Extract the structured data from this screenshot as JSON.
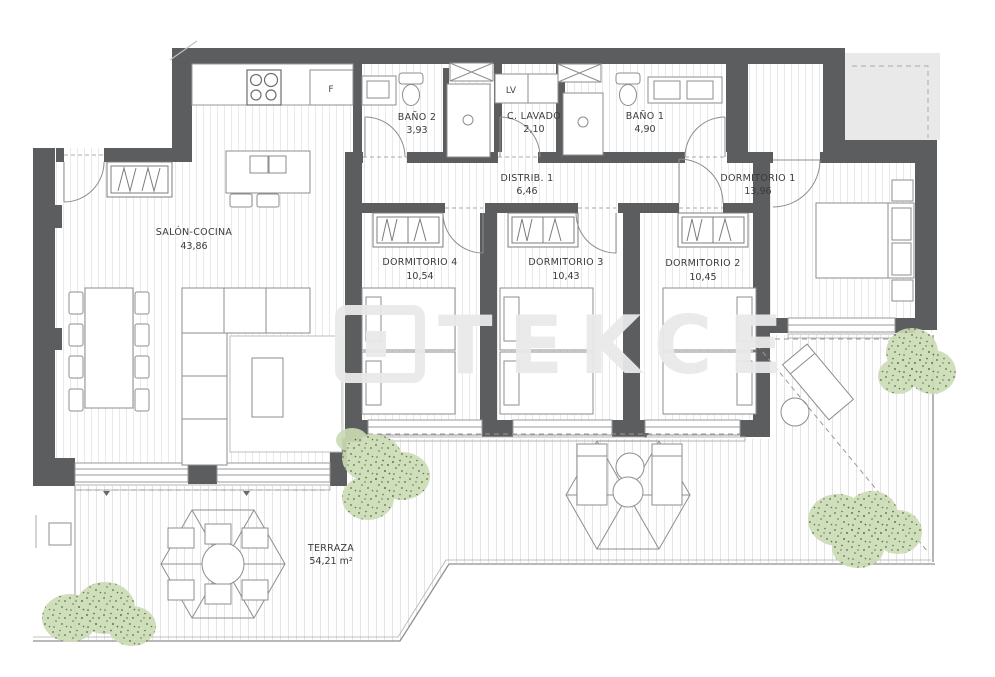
{
  "plan": {
    "watermark": "TEKCE",
    "rooms": [
      {
        "id": "salon",
        "name": "SALÓN-COCINA",
        "area": "43,86"
      },
      {
        "id": "bano2",
        "name": "BAÑO 2",
        "area": "3,93"
      },
      {
        "id": "lavado",
        "name": "C. LAVADO",
        "area": "2,10"
      },
      {
        "id": "bano1",
        "name": "BAÑO 1",
        "area": "4,90"
      },
      {
        "id": "distrib",
        "name": "DISTRIB. 1",
        "area": "6,46"
      },
      {
        "id": "dorm1",
        "name": "DORMITORIO 1",
        "area": "13,96"
      },
      {
        "id": "dorm4",
        "name": "DORMITORIO 4",
        "area": "10,54"
      },
      {
        "id": "dorm3",
        "name": "DORMITORIO 3",
        "area": "10,43"
      },
      {
        "id": "dorm2",
        "name": "DORMITORIO 2",
        "area": "10,45"
      },
      {
        "id": "terraza",
        "name": "TERRAZA",
        "area": "54,21 m²"
      }
    ],
    "fixtures": {
      "fridge_label": "F",
      "washer_label": "LV"
    },
    "colors": {
      "wall": "#5c5d5f",
      "furniture_line": "#8e8e90",
      "light_line": "#b5b5b5",
      "text": "#3b3b3c",
      "bush_fill": "#ccdcb4",
      "bush_dots": "#51603d",
      "neighbor_fill": "#e9e9e9",
      "watermark": "#e9e9e9",
      "floor_stripe": "#e9e9e9",
      "terrace_stripe": "#e4e4e4"
    }
  }
}
